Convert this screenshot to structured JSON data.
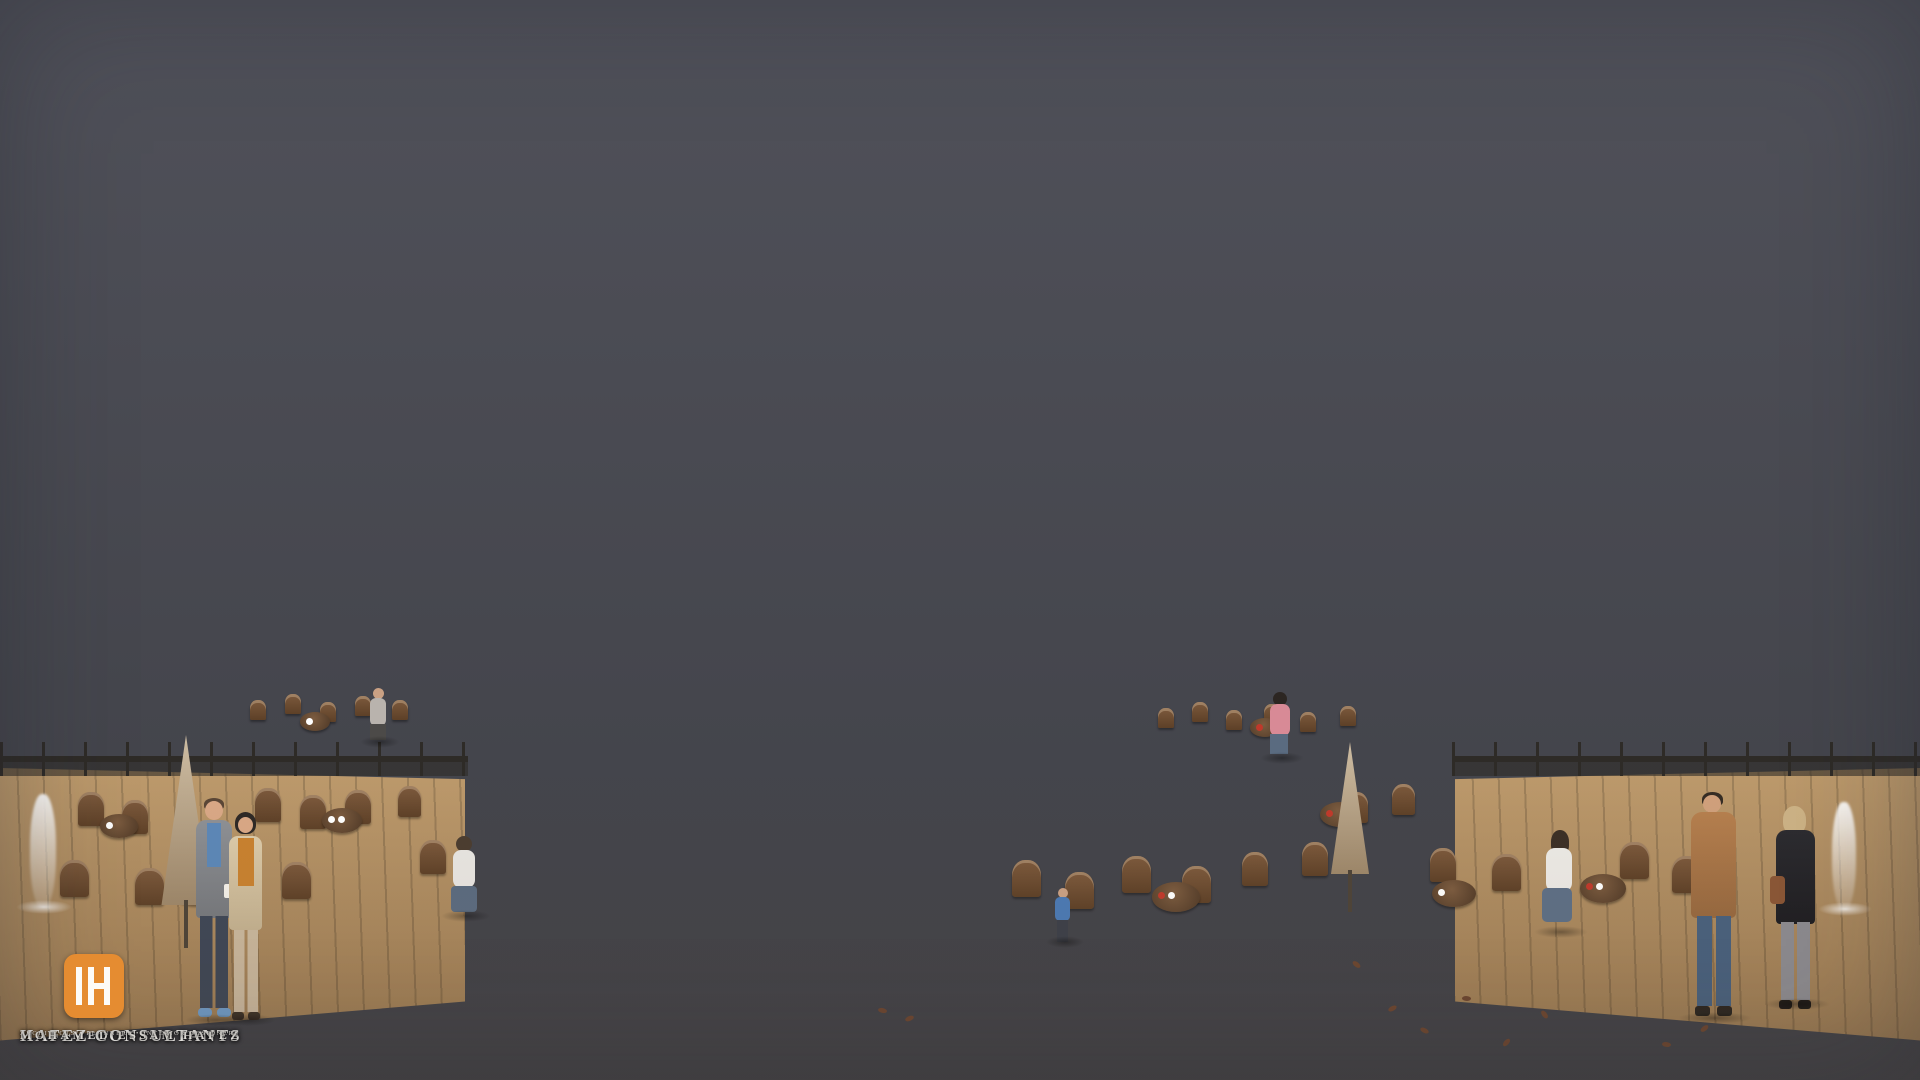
{
  "scene_meta": {
    "description": "Overcast-dusk architectural rendering of a modern residential compound courtyard: white, granite and brick apartment blocks with warmly lit windows flank a central paved plaza with cascading planter water-walls, pools, palm trees, outdoor cafe seating and strolling residents.",
    "time_of_day": "overcast dusk",
    "style": "photoreal 3D visualization"
  },
  "logo": {
    "mark_letter": "H",
    "company": "HAFEZ CONSULTANTS",
    "principal": "MOHAMED ESSAM HAFEZ",
    "tagline": "ARCHITECTS • PLANNERS • INTERIOR DESIGNERS",
    "accent_color": "#e58c31"
  },
  "palette": {
    "sky": "#ccd0d7",
    "cloud": "#9aa0ab",
    "facade_white": "#f0efeb",
    "granite": "#8e8b89",
    "brick": "#80493a",
    "window_glow": "#f2bd77",
    "plaza": "#a09d98",
    "plaza_stripe": "#45464c",
    "cafe_deck": "#b3906a",
    "foliage": "#415233",
    "pool_water": "#7fb3af"
  },
  "scene_counts": {
    "people": 9,
    "palm_trees": 7,
    "closed_umbrellas": 2,
    "fountain_jets": 2,
    "pools": 2
  }
}
